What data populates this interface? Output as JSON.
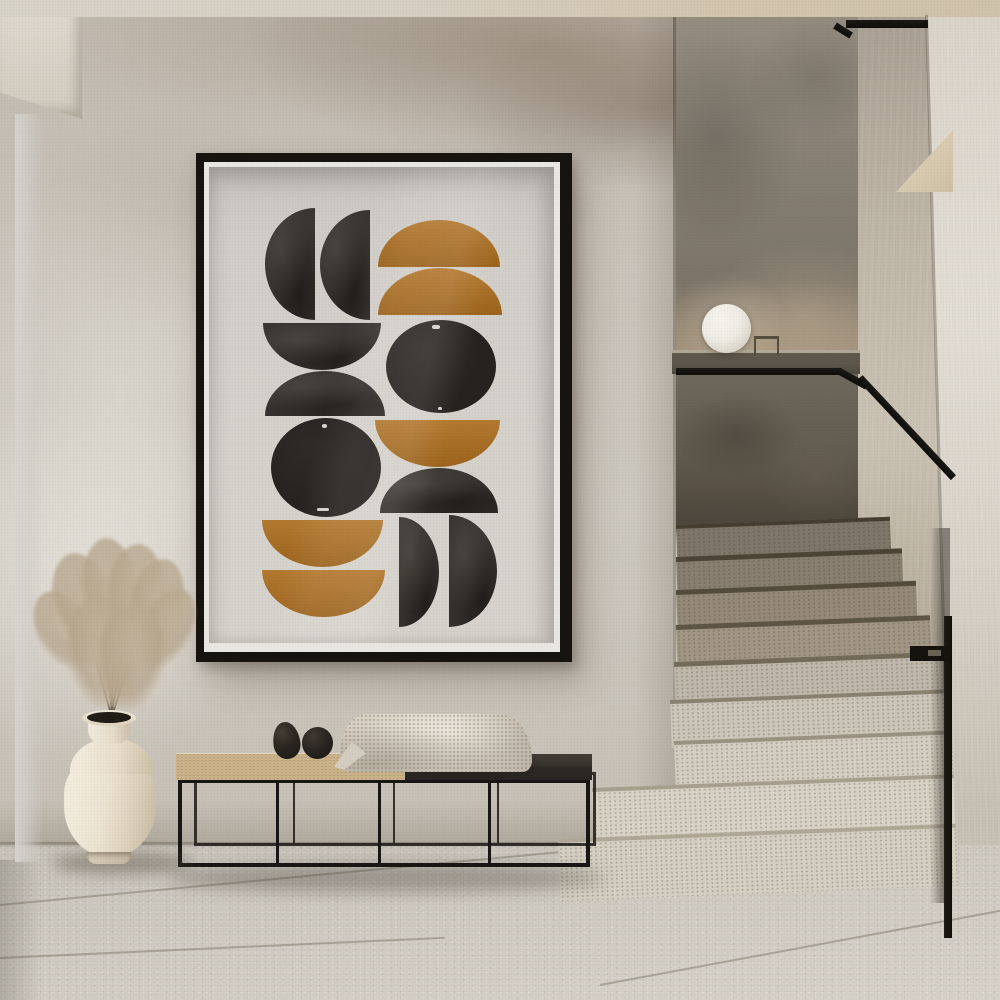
{
  "scene": {
    "type": "interior-photograph",
    "description": "Minimalist hallway: framed mid-century abstract art print on a plaster wall, white vase with dried pampas grass, low metal-frame bench with black egg decor and a knit throw, terrazzo staircase with black handrail and a white sphere lamp on a stone ledge",
    "objects": [
      "abstract-art-print",
      "plaster-wall",
      "glass-door-edge",
      "pampas-vase",
      "bench",
      "decor-eggs",
      "knit-blanket",
      "sphere-lamp",
      "stone-ledge",
      "black-handrail",
      "terrazzo-steps",
      "tile-floor"
    ]
  },
  "artwork": {
    "frame": {
      "color": "#17140f",
      "mat_color": "#e9e7e2"
    },
    "canvas": {
      "background": "#d3d0ca",
      "width": 350,
      "height": 483
    },
    "shapes": [
      {
        "id": "half-black-top-1",
        "type": "dleft",
        "color": "ink",
        "x": 56,
        "y": 41,
        "w": 50,
        "h": 112
      },
      {
        "id": "half-black-top-2",
        "type": "dleft",
        "color": "ink",
        "x": 111,
        "y": 43,
        "w": 50,
        "h": 110
      },
      {
        "id": "ochre-dome-1",
        "type": "dome",
        "color": "ochre",
        "x": 169,
        "y": 53,
        "w": 122,
        "h": 47
      },
      {
        "id": "ochre-dome-2",
        "type": "dome",
        "color": "ochre",
        "x": 169,
        "y": 101,
        "w": 124,
        "h": 47
      },
      {
        "id": "black-bowl-left",
        "type": "bowl",
        "color": "ink",
        "x": 54,
        "y": 156,
        "w": 118,
        "h": 47
      },
      {
        "id": "black-dome-left",
        "type": "dome",
        "color": "ink",
        "x": 56,
        "y": 204,
        "w": 120,
        "h": 45
      },
      {
        "id": "black-circle-right",
        "type": "circle",
        "color": "inksolid",
        "x": 177,
        "y": 153,
        "w": 110,
        "h": 93
      },
      {
        "id": "ochre-bowl-mid",
        "type": "bowl",
        "color": "ochre",
        "x": 166,
        "y": 253,
        "w": 125,
        "h": 47
      },
      {
        "id": "black-dome-mid",
        "type": "dome",
        "color": "ink",
        "x": 171,
        "y": 301,
        "w": 118,
        "h": 45
      },
      {
        "id": "black-circle-left",
        "type": "circle",
        "color": "inksolid",
        "x": 62,
        "y": 251,
        "w": 110,
        "h": 99
      },
      {
        "id": "ochre-bowl-bottom-1",
        "type": "bowl",
        "color": "ochre",
        "x": 53,
        "y": 353,
        "w": 121,
        "h": 47
      },
      {
        "id": "ochre-bowl-bottom-2",
        "type": "bowl",
        "color": "ochre",
        "x": 53,
        "y": 403,
        "w": 123,
        "h": 47
      },
      {
        "id": "half-black-bottom-1",
        "type": "dright",
        "color": "ink",
        "x": 190,
        "y": 350,
        "w": 40,
        "h": 110
      },
      {
        "id": "half-black-bottom-2",
        "type": "dright",
        "color": "ink",
        "x": 240,
        "y": 348,
        "w": 48,
        "h": 112
      }
    ],
    "specks": [
      {
        "x": 223,
        "y": 158,
        "w": 8,
        "h": 4
      },
      {
        "x": 229,
        "y": 240,
        "w": 4,
        "h": 3
      },
      {
        "x": 113,
        "y": 257,
        "w": 5,
        "h": 4
      },
      {
        "x": 108,
        "y": 341,
        "w": 12,
        "h": 3
      }
    ]
  },
  "palette": {
    "wall": "#c9c3ba",
    "ceiling": "#d5cec2",
    "frame": "#17140f",
    "mat": "#e9e7e2",
    "print-bg": "#d3d0ca",
    "ink": "#34312e",
    "ink-solid": "#262220",
    "ochre": "#ae6f20",
    "door-frame": "#3b372e",
    "stair-backwall": "#8d857a",
    "right-wall": "#bdb4a5",
    "right-column": "#dcd6cc",
    "handrail": "#15130e",
    "step-shadow": "#8a8071",
    "step-light": "#d5d0c3",
    "floor": "#cfcac1",
    "bench-wood": "#cbb28b",
    "bench-dark": "#2d2925",
    "blanket": "#d9d2c5",
    "vase": "#ece3d1",
    "pampas": "#b3a189",
    "lamp": "#f0ede6",
    "egg": "#211e1b"
  }
}
